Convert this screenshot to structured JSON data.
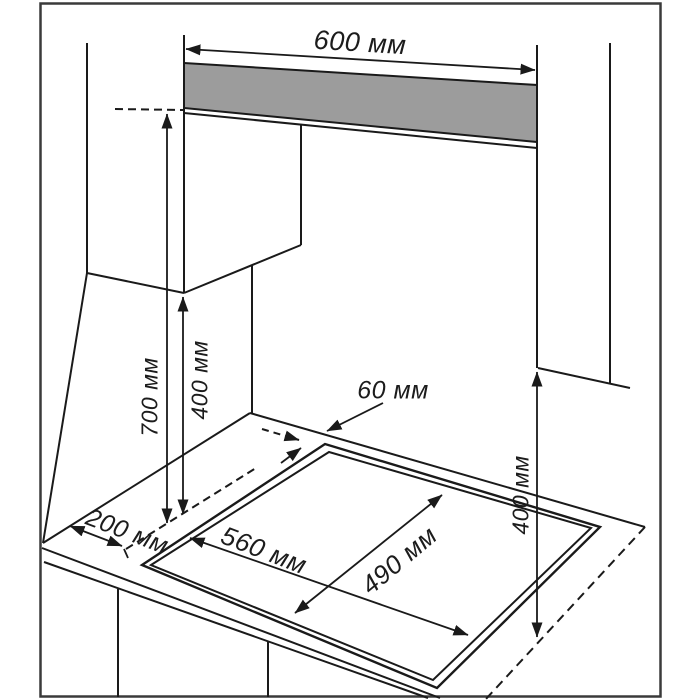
{
  "diagram": {
    "title": "hob-installation-dimensions",
    "units": "мм",
    "labels": {
      "niche_width": "600 мм",
      "height_worktop_to_hood": "700 мм",
      "left_cabinet_clearance": "400 мм",
      "right_cabinet_clearance": "400 мм",
      "rear_gap": "60 мм",
      "left_edge_distance": "200 мм",
      "cutout_width": "560 мм",
      "cutout_depth": "490 мм"
    },
    "colors": {
      "line": "#1a1a1a",
      "hood_panel_gray": "#9c9c9c",
      "background": "#ffffff",
      "border": "#3a3a3a"
    }
  }
}
